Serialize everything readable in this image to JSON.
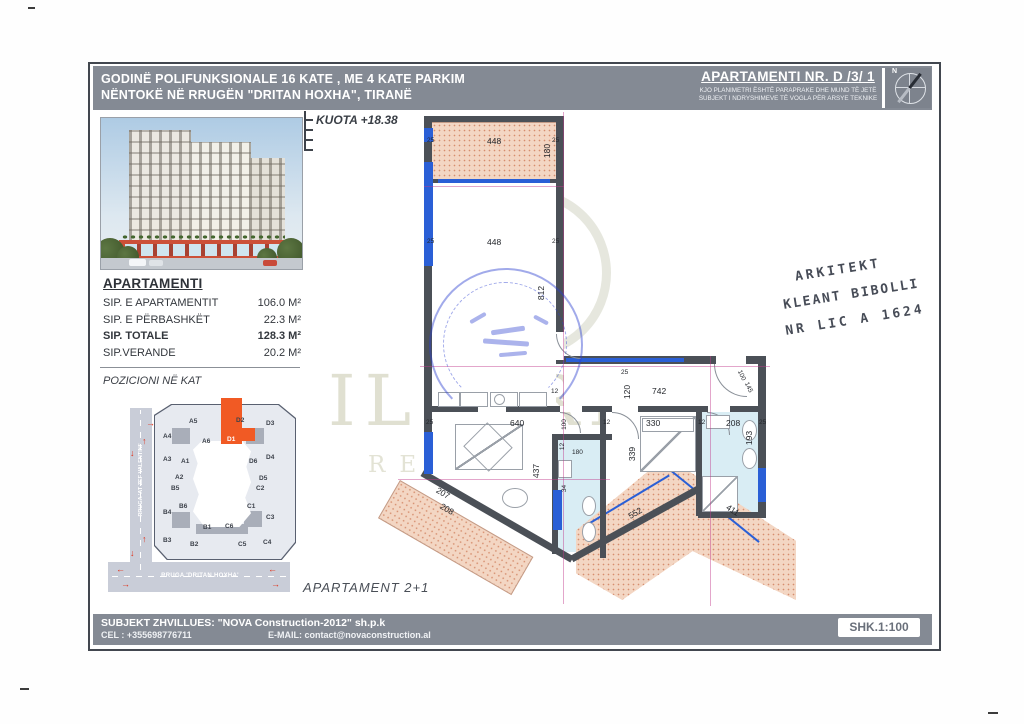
{
  "header": {
    "title_line1": "GODINË POLIFUNKSIONALE 16 KATE , ME 4 KATE PARKIM",
    "title_line2": "NËNTOKË NË RRUGËN \"DRITAN HOXHA\", TIRANË",
    "apartment_no": "APARTAMENTI NR. D /3/ 1",
    "disclaimer_line1": "KJO PLANIMETRI ËSHTË PARAPRAKE DHE MUND TË JETË",
    "disclaimer_line2": "SUBJEKT I NDRYSHIMEVE TË VOGLA PËR ARSYE TEKNIKE",
    "compass_label": "N"
  },
  "panel": {
    "heading": "APARTAMENTI",
    "rows": [
      {
        "label": "SIP. E APARTAMENTIT",
        "value": "106.0 M²",
        "bold": false
      },
      {
        "label": "SIP. E PËRBASHKËT",
        "value": "22.3 M²",
        "bold": false
      },
      {
        "label": "SIP. TOTALE",
        "value": "128.3 M²",
        "bold": true
      },
      {
        "label": "SIP.VERANDE",
        "value": "20.2 M²",
        "bold": false
      }
    ],
    "position_heading": "POZICIONI NË KAT"
  },
  "keyplan": {
    "street_left": "RRUGA 'AT ZEF VALENTINI'",
    "street_bottom": "RRUGA 'DRITAN HOXHA'",
    "highlighted_unit": "D1",
    "units": [
      {
        "t": "A5",
        "x": 189,
        "y": 418
      },
      {
        "t": "D2",
        "x": 236,
        "y": 417
      },
      {
        "t": "D3",
        "x": 266,
        "y": 420
      },
      {
        "t": "A4",
        "x": 163,
        "y": 433
      },
      {
        "t": "A6",
        "x": 202,
        "y": 438
      },
      {
        "t": "D1",
        "x": 227,
        "y": 436,
        "hl": true
      },
      {
        "t": "A3",
        "x": 163,
        "y": 456
      },
      {
        "t": "A1",
        "x": 181,
        "y": 458
      },
      {
        "t": "D6",
        "x": 249,
        "y": 458
      },
      {
        "t": "D4",
        "x": 266,
        "y": 454
      },
      {
        "t": "A2",
        "x": 175,
        "y": 474
      },
      {
        "t": "D5",
        "x": 259,
        "y": 475
      },
      {
        "t": "B5",
        "x": 171,
        "y": 485
      },
      {
        "t": "C2",
        "x": 256,
        "y": 485
      },
      {
        "t": "B4",
        "x": 163,
        "y": 509
      },
      {
        "t": "B6",
        "x": 179,
        "y": 503
      },
      {
        "t": "C1",
        "x": 247,
        "y": 503
      },
      {
        "t": "C3",
        "x": 266,
        "y": 514
      },
      {
        "t": "B3",
        "x": 163,
        "y": 537
      },
      {
        "t": "B1",
        "x": 203,
        "y": 524
      },
      {
        "t": "C6",
        "x": 225,
        "y": 523
      },
      {
        "t": "B2",
        "x": 190,
        "y": 541
      },
      {
        "t": "C5",
        "x": 238,
        "y": 541
      },
      {
        "t": "C4",
        "x": 263,
        "y": 539
      }
    ],
    "arrows": [
      {
        "g": "→",
        "x": 146,
        "y": 418
      },
      {
        "g": "↑",
        "x": 142,
        "y": 436
      },
      {
        "g": "↓",
        "x": 130,
        "y": 448
      },
      {
        "g": "↑",
        "x": 142,
        "y": 534
      },
      {
        "g": "↓",
        "x": 130,
        "y": 548
      },
      {
        "g": "←",
        "x": 116,
        "y": 564
      },
      {
        "g": "→",
        "x": 121,
        "y": 579
      },
      {
        "g": "←",
        "x": 268,
        "y": 564
      },
      {
        "g": "→",
        "x": 271,
        "y": 579
      }
    ]
  },
  "plan": {
    "kuota_label": "KUOTA +18.38",
    "apartment_type_label": "APARTAMENT 2+1",
    "dimensions": [
      {
        "t": "448",
        "x": 487,
        "y": 136
      },
      {
        "t": "25",
        "x": 427,
        "y": 137,
        "s": 1
      },
      {
        "t": "25",
        "x": 552,
        "y": 137,
        "s": 1
      },
      {
        "t": "180",
        "x": 540,
        "y": 146,
        "r": -90
      },
      {
        "t": "448",
        "x": 487,
        "y": 237
      },
      {
        "t": "25",
        "x": 427,
        "y": 238,
        "s": 1
      },
      {
        "t": "25",
        "x": 552,
        "y": 238,
        "s": 1
      },
      {
        "t": "812",
        "x": 534,
        "y": 288,
        "r": -90
      },
      {
        "t": "742",
        "x": 652,
        "y": 386
      },
      {
        "t": "120",
        "x": 620,
        "y": 387,
        "r": -90
      },
      {
        "t": "25",
        "x": 621,
        "y": 369,
        "s": 1
      },
      {
        "t": "100",
        "x": 736,
        "y": 372,
        "r": 65,
        "s": 1
      },
      {
        "t": "145",
        "x": 743,
        "y": 384,
        "r": 65,
        "s": 1
      },
      {
        "t": "640",
        "x": 510,
        "y": 418
      },
      {
        "t": "25",
        "x": 426,
        "y": 419,
        "s": 1
      },
      {
        "t": "12",
        "x": 551,
        "y": 388,
        "s": 1
      },
      {
        "t": "100",
        "x": 559,
        "y": 421,
        "r": -90,
        "s": 1
      },
      {
        "t": "12",
        "x": 559,
        "y": 443,
        "r": -90,
        "s": 1
      },
      {
        "t": "180",
        "x": 572,
        "y": 449,
        "s": 1
      },
      {
        "t": "12",
        "x": 603,
        "y": 419,
        "s": 1
      },
      {
        "t": "330",
        "x": 646,
        "y": 418
      },
      {
        "t": "12",
        "x": 698,
        "y": 419,
        "s": 1
      },
      {
        "t": "208",
        "x": 726,
        "y": 418
      },
      {
        "t": "25",
        "x": 759,
        "y": 419,
        "s": 1
      },
      {
        "t": "193",
        "x": 742,
        "y": 433,
        "r": -90
      },
      {
        "t": "339",
        "x": 625,
        "y": 449,
        "r": -90
      },
      {
        "t": "437",
        "x": 529,
        "y": 466,
        "r": -90
      },
      {
        "t": "34",
        "x": 561,
        "y": 485,
        "r": -90,
        "s": 1
      },
      {
        "t": "207",
        "x": 436,
        "y": 488,
        "r": 30
      },
      {
        "t": "208",
        "x": 440,
        "y": 504,
        "r": 30
      },
      {
        "t": "552",
        "x": 628,
        "y": 508,
        "r": -30
      },
      {
        "t": "411",
        "x": 726,
        "y": 505,
        "r": 33
      }
    ]
  },
  "watermark": {
    "line1": "ILLYRIAN",
    "line2": "REAL ESTATE"
  },
  "architect_stamp": {
    "line1": "ARKITEKT",
    "line2": "KLEANT BIBOLLI",
    "line3": "NR LIC A 1624"
  },
  "footer": {
    "developer": "SUBJEKT ZHVILLUES: \"NOVA Construction-2012\" sh.p.k",
    "cel": "CEL : +355698776711",
    "email": "E-MAIL: contact@novaconstruction.al",
    "scale": "SHK.1:100"
  },
  "colors": {
    "header_gray": "#848a94",
    "highlight_orange": "#f15a24",
    "terrace_pink": "#f3d6c3",
    "bath_blue": "#d9edf4",
    "window_blue": "#2a5fd6",
    "wall_gray": "#4b5057"
  }
}
